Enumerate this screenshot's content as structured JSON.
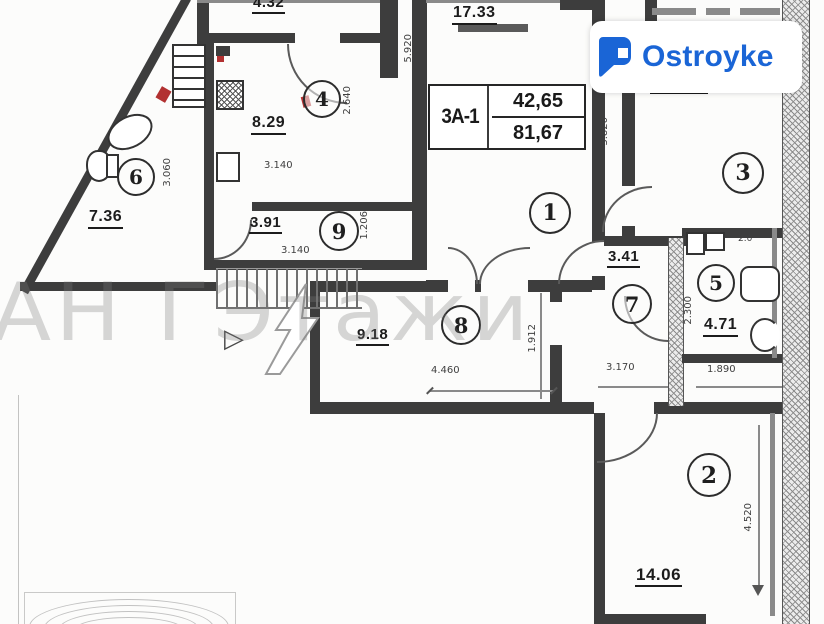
{
  "brand": {
    "name": "Ostroyke",
    "accent_color": "#1a65d6"
  },
  "watermark": {
    "agency_text": "АН ГЭтажи"
  },
  "unit_card": {
    "unit": "3А-1",
    "value_top": "42,65",
    "value_bottom": "81,67"
  },
  "room_numbers": {
    "living_room": "1",
    "bedroom_bottom": "2",
    "bedroom_top": "3",
    "kitchen": "4",
    "bathroom_right": "5",
    "bathroom_left": "6",
    "hall_right": "7",
    "corridor": "8",
    "hall_top": "9"
  },
  "area_labels": {
    "balcony_top": "4.32",
    "living_top": "17.33",
    "kitchen": "8.29",
    "bathroom_left": "7.36",
    "hall_top": "3.91",
    "corridor": "9.18",
    "hall_right": "3.41",
    "bathroom_right": "4.71",
    "bedroom_bottom": "14.06"
  },
  "dimensions": {
    "v5920": "5.920",
    "v2640": "2.640",
    "h3140_kitchen": "3.140",
    "v3060": "3.060",
    "h3140_hall": "3.140",
    "v1206": "1.206",
    "h4460": "4.460",
    "v1912": "1.912",
    "h3170": "3.170",
    "v2300": "2.300",
    "h1890": "1.890",
    "v3820": "3.820",
    "v4520": "4.520",
    "small_right": "2.0"
  },
  "symbols": {
    "door_triangle": "▷"
  }
}
